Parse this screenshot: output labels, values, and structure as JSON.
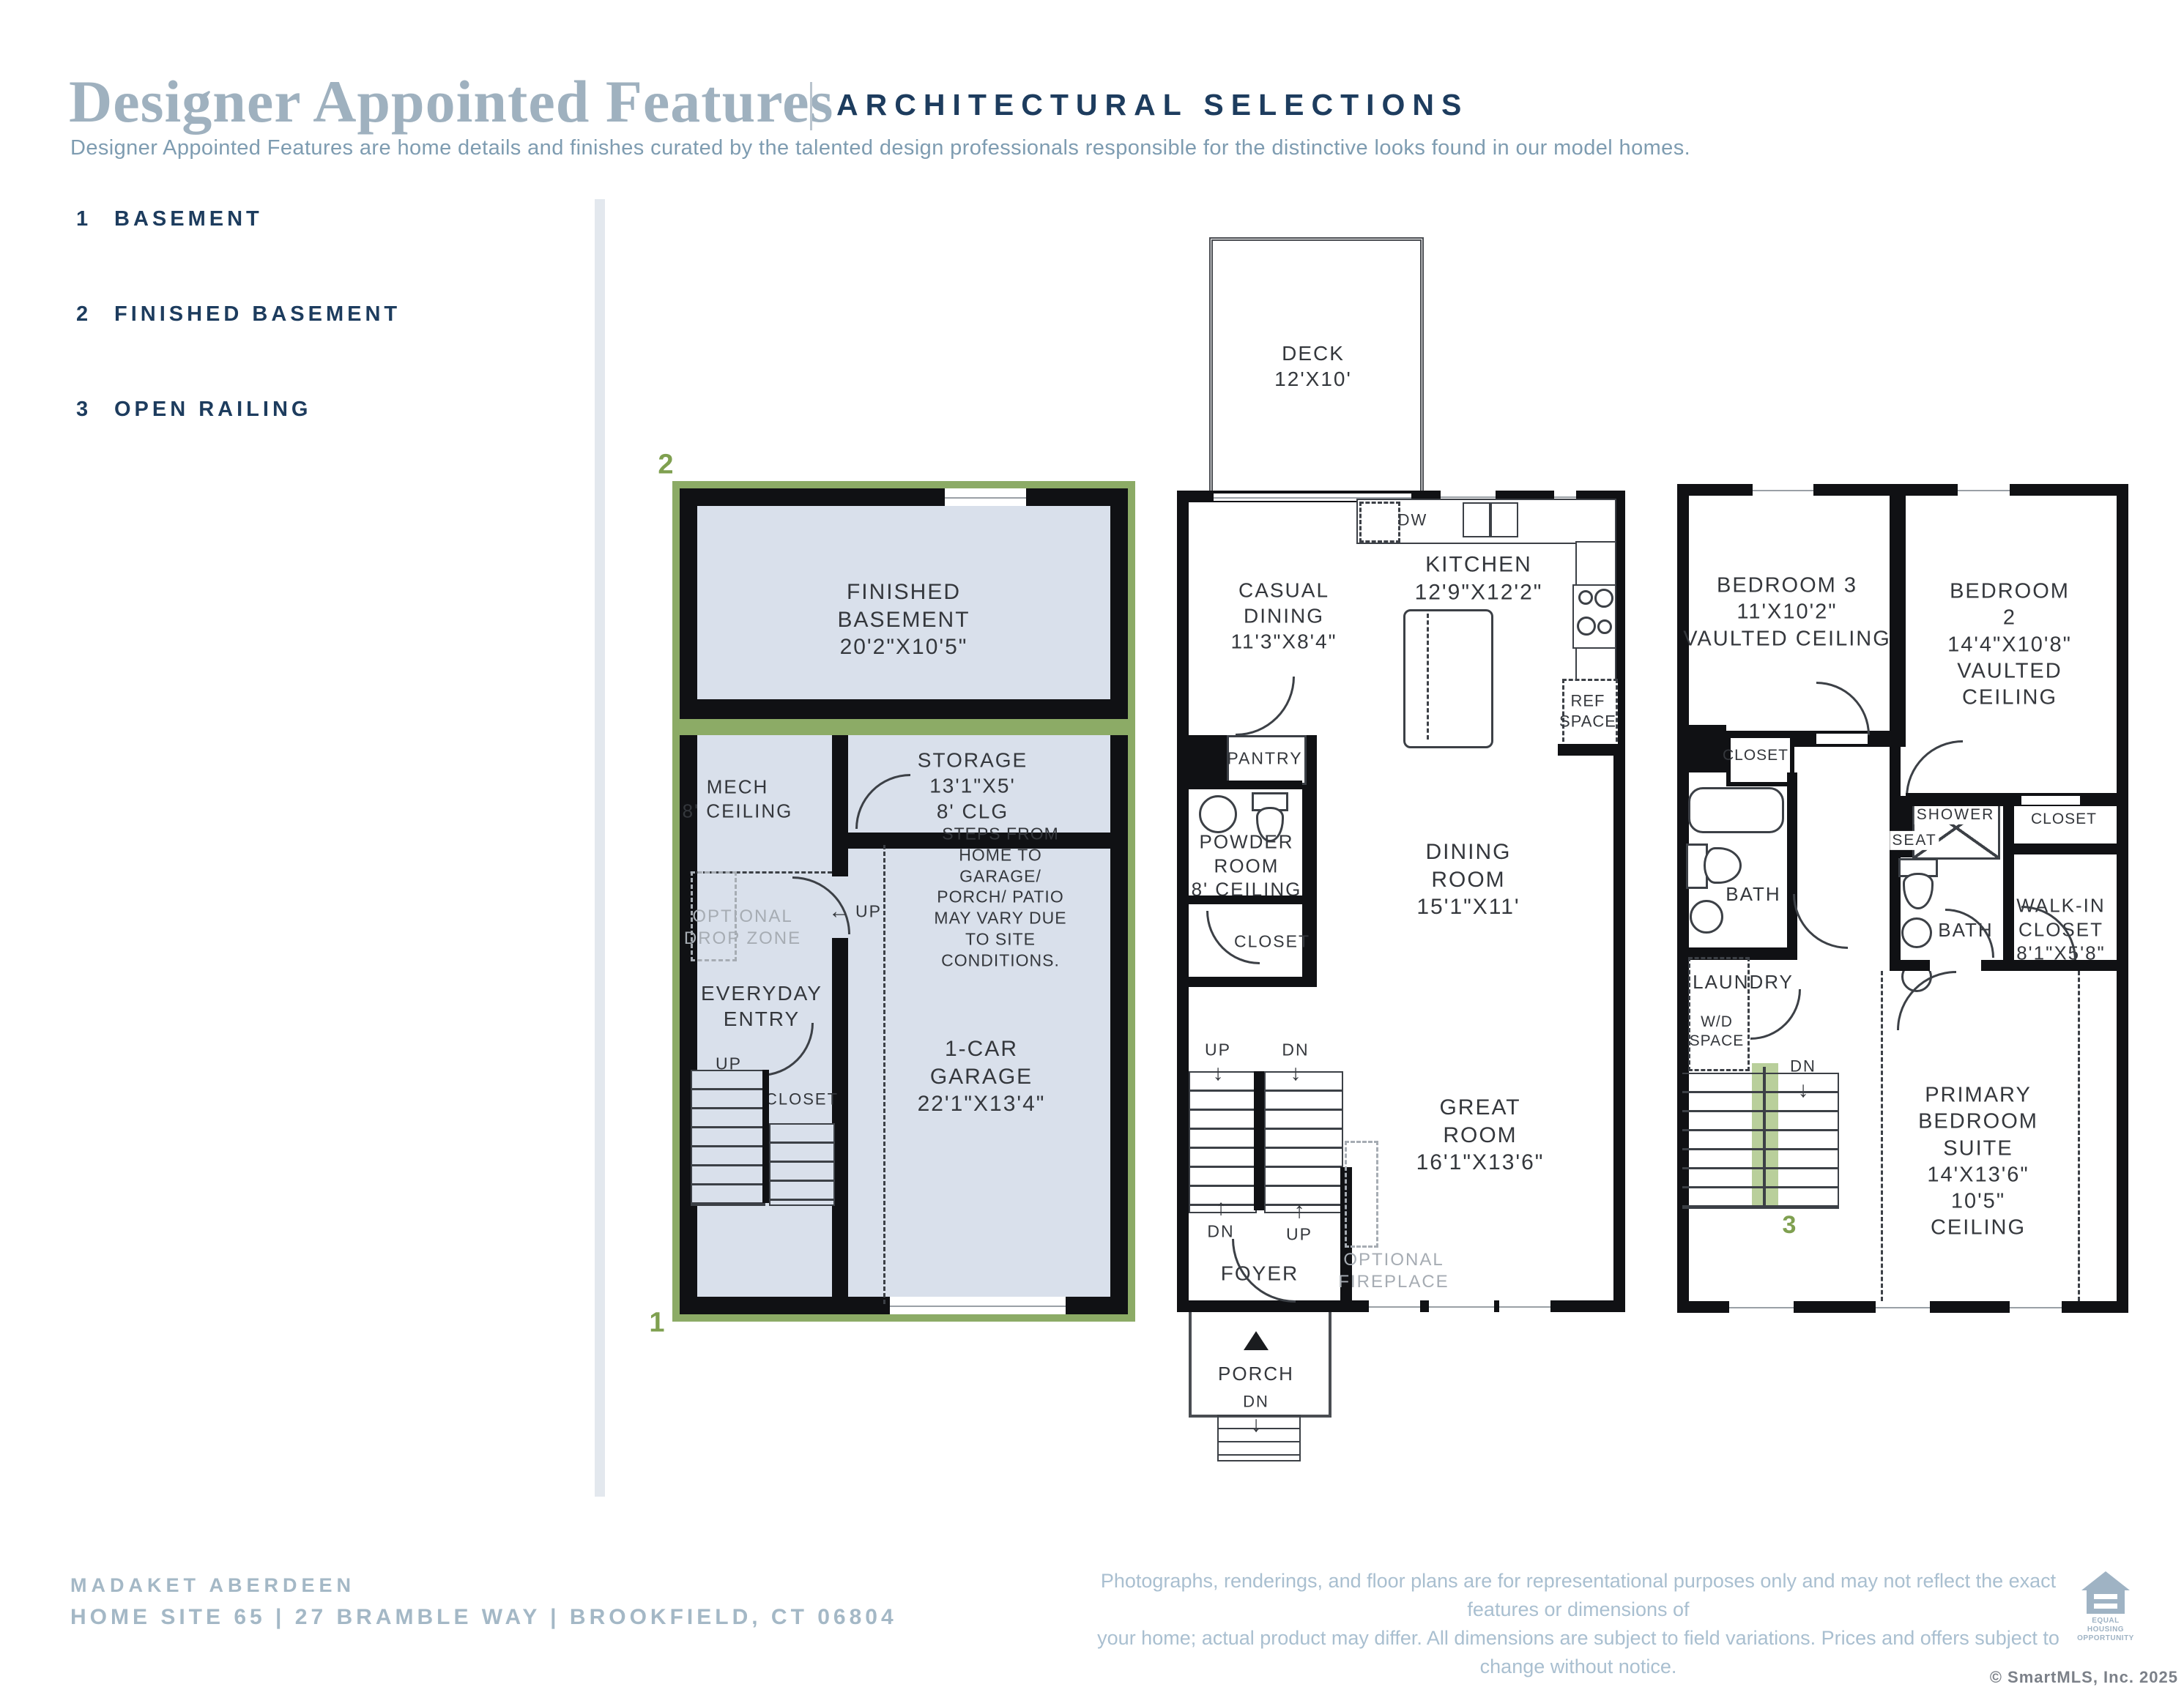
{
  "header": {
    "title": "Designer Appointed Features",
    "subtitle": "ARCHITECTURAL SELECTIONS",
    "description": "Designer Appointed Features are home details and finishes curated by the talented design professionals responsible for the distinctive looks found in our model homes."
  },
  "legend": {
    "items": [
      {
        "number": "1",
        "label": "BASEMENT"
      },
      {
        "number": "2",
        "label": "FINISHED BASEMENT"
      },
      {
        "number": "3",
        "label": "OPEN RAILING"
      }
    ]
  },
  "icons": {
    "arrow_down": "↓",
    "arrow_up": "↑",
    "arrow_left": "←",
    "triangle_up": "▲"
  },
  "colors": {
    "navy": "#1d3c5e",
    "title_blue": "#9fb1bf",
    "highlight_green": "#8cab66",
    "highlight_green_light": "#b9cf9b",
    "room_fill": "#d9e0eb",
    "footer_blue": "#a4b8c6"
  },
  "basement": {
    "marker_finished": "2",
    "marker_basement": "1",
    "finished_basement": "FINISHED\nBASEMENT\n20'2\"X10'5\"",
    "mech": "MECH\n8' CEILING",
    "storage": "STORAGE\n13'1\"X5'\n8' CLG",
    "steps_note": "STEPS FROM HOME TO\nGARAGE/ PORCH/ PATIO\nMAY VARY DUE TO SITE\nCONDITIONS.",
    "drop_zone": "OPTIONAL\nDROP ZONE",
    "everyday_entry": "EVERYDAY\nENTRY",
    "closet": "CLOSET",
    "garage": "1-CAR\nGARAGE\n22'1\"X13'4\"",
    "up": "UP",
    "dn": "DN"
  },
  "first_floor": {
    "deck": "DECK\n12'X10'",
    "casual_dining": "CASUAL\nDINING\n11'3\"X8'4\"",
    "kitchen": "KITCHEN\n12'9\"X12'2\"",
    "dw": "DW",
    "ref_space": "REF\nSPACE",
    "pantry": "PANTRY",
    "powder_room": "POWDER\nROOM\n8' CEILING",
    "closet": "CLOSET",
    "dining_room": "DINING ROOM\n15'1\"X11'",
    "great_room": "GREAT ROOM\n16'1\"X13'6\"",
    "optional_fireplace": "OPTIONAL\nFIREPLACE",
    "foyer": "FOYER",
    "porch": "PORCH",
    "up": "UP",
    "dn": "DN"
  },
  "second_floor": {
    "bedroom3": "BEDROOM 3\n11'X10'2\"\nVAULTED CEILING",
    "bedroom2": "BEDROOM 2\n14'4\"X10'8\"\nVAULTED CEILING",
    "closet_left": "CLOSET",
    "bath_left": "BATH",
    "laundry": "LAUNDRY",
    "wd_space": "W/D\nSPACE",
    "shower": "SHOWER",
    "seat": "SEAT",
    "bath_mid": "BATH",
    "closet_right": "CLOSET",
    "walk_in_closet": "WALK-IN\nCLOSET\n8'1\"X5'8\"",
    "primary_suite": "PRIMARY\nBEDROOM SUITE\n14'X13'6\"\n10'5\" CEILING",
    "marker_open_railing": "3",
    "dn": "DN"
  },
  "footer": {
    "community": "MADAKET ABERDEEN",
    "address": "HOME SITE 65  |  27 BRAMBLE WAY  |  BROOKFIELD, CT 06804",
    "disclaimer": "Photographs, renderings, and floor plans are for representational purposes only and may not reflect the exact features or dimensions of\nyour home; actual product may differ. All dimensions are subject to field variations. Prices and offers subject to change without notice.\nThis is not an offering where prohibited by law. Not all images may be shown. See online or onsite Sales Consultants for details.",
    "eho": "EQUAL HOUSING\nOPPORTUNITY",
    "copyright": "© SmartMLS, Inc.  2025"
  }
}
